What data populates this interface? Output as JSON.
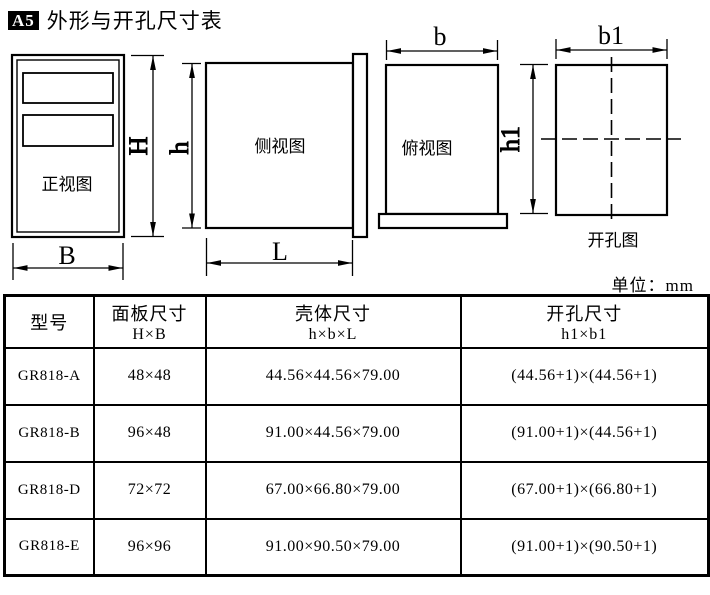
{
  "title": {
    "badge": "A5",
    "text": "外形与开孔尺寸表"
  },
  "unit_label": "单位：mm",
  "drawings": {
    "front_view": {
      "label": "正视图",
      "dim_height": "H",
      "dim_width": "B"
    },
    "side_view": {
      "label": "侧视图",
      "dim_height": "h",
      "dim_length": "L"
    },
    "top_view": {
      "label": "俯视图",
      "dim_width": "b",
      "dim_height1": "h1"
    },
    "cutout_view": {
      "label": "开孔图",
      "dim_width1": "b1"
    }
  },
  "table": {
    "headers": [
      {
        "title": "型号",
        "sub": ""
      },
      {
        "title": "面板尺寸",
        "sub": "H×B"
      },
      {
        "title": "壳体尺寸",
        "sub": "h×b×L"
      },
      {
        "title": "开孔尺寸",
        "sub": "h1×b1"
      }
    ],
    "rows": [
      {
        "model": "GR818-A",
        "panel": "48×48",
        "case": "44.56×44.56×79.00",
        "cutout": "(44.56+1)×(44.56+1)"
      },
      {
        "model": "GR818-B",
        "panel": "96×48",
        "case": "91.00×44.56×79.00",
        "cutout": "(91.00+1)×(44.56+1)"
      },
      {
        "model": "GR818-D",
        "panel": "72×72",
        "case": "67.00×66.80×79.00",
        "cutout": "(67.00+1)×(66.80+1)"
      },
      {
        "model": "GR818-E",
        "panel": "96×96",
        "case": "91.00×90.50×79.00",
        "cutout": "(91.00+1)×(90.50+1)"
      }
    ]
  },
  "colors": {
    "ink": "#000000",
    "paper": "#ffffff"
  }
}
